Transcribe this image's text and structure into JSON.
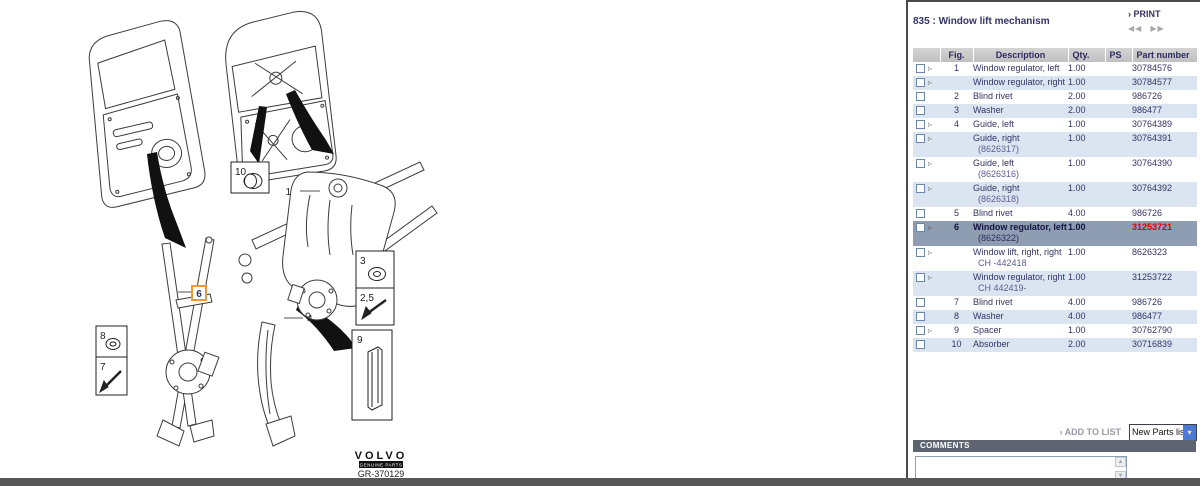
{
  "header": {
    "title": "835 : Window lift mechanism",
    "print": {
      "chevron": "›",
      "label": "PRINT"
    },
    "pager": {
      "prev": "◀◀",
      "next": "▶▶"
    }
  },
  "table": {
    "columns": {
      "checkbox": "",
      "fig": "Fig.",
      "description": "Description",
      "qty": "Qty.",
      "ps": "PS",
      "part": "Part number"
    },
    "rows": [
      {
        "fig": "1",
        "desc": "Window regulator, left",
        "sub": "",
        "qty": "1.00",
        "ps": "",
        "part": "30784576",
        "arrow": true,
        "selected": false,
        "part_red": false
      },
      {
        "fig": "",
        "desc": "Window regulator, right",
        "sub": "",
        "qty": "1.00",
        "ps": "",
        "part": "30784577",
        "arrow": true,
        "selected": false,
        "part_red": false
      },
      {
        "fig": "2",
        "desc": "Blind rivet",
        "sub": "",
        "qty": "2.00",
        "ps": "",
        "part": "986726",
        "arrow": false,
        "selected": false,
        "part_red": false
      },
      {
        "fig": "3",
        "desc": "Washer",
        "sub": "",
        "qty": "2.00",
        "ps": "",
        "part": "986477",
        "arrow": false,
        "selected": false,
        "part_red": false
      },
      {
        "fig": "4",
        "desc": "Guide, left",
        "sub": "",
        "qty": "1.00",
        "ps": "",
        "part": "30764389",
        "arrow": true,
        "selected": false,
        "part_red": false
      },
      {
        "fig": "",
        "desc": "Guide, right",
        "sub": "(8626317)",
        "qty": "1.00",
        "ps": "",
        "part": "30764391",
        "arrow": true,
        "selected": false,
        "part_red": false
      },
      {
        "fig": "",
        "desc": "Guide, left",
        "sub": "(8626316)",
        "qty": "1.00",
        "ps": "",
        "part": "30764390",
        "arrow": true,
        "selected": false,
        "part_red": false
      },
      {
        "fig": "",
        "desc": "Guide, right",
        "sub": "(8626318)",
        "qty": "1.00",
        "ps": "",
        "part": "30764392",
        "arrow": true,
        "selected": false,
        "part_red": false
      },
      {
        "fig": "5",
        "desc": "Blind rivet",
        "sub": "",
        "qty": "4.00",
        "ps": "",
        "part": "986726",
        "arrow": false,
        "selected": false,
        "part_red": false
      },
      {
        "fig": "6",
        "desc": "Window regulator, left",
        "sub": "(8626322)",
        "qty": "1.00",
        "ps": "",
        "part": "31253721",
        "arrow": true,
        "selected": true,
        "part_red": true
      },
      {
        "fig": "",
        "desc": "Window lift, right, right",
        "sub": "CH -442418",
        "qty": "1.00",
        "ps": "",
        "part": "8626323",
        "arrow": true,
        "selected": false,
        "part_red": false
      },
      {
        "fig": "",
        "desc": "Window regulator, right",
        "sub": "CH 442419-",
        "qty": "1.00",
        "ps": "",
        "part": "31253722",
        "arrow": true,
        "selected": false,
        "part_red": false
      },
      {
        "fig": "7",
        "desc": "Blind rivet",
        "sub": "",
        "qty": "4.00",
        "ps": "",
        "part": "986726",
        "arrow": false,
        "selected": false,
        "part_red": false
      },
      {
        "fig": "8",
        "desc": "Washer",
        "sub": "",
        "qty": "4.00",
        "ps": "",
        "part": "986477",
        "arrow": false,
        "selected": false,
        "part_red": false
      },
      {
        "fig": "9",
        "desc": "Spacer",
        "sub": "",
        "qty": "1.00",
        "ps": "",
        "part": "30762790",
        "arrow": true,
        "selected": false,
        "part_red": false
      },
      {
        "fig": "10",
        "desc": "Absorber",
        "sub": "",
        "qty": "2.00",
        "ps": "",
        "part": "30716839",
        "arrow": false,
        "selected": false,
        "part_red": false
      }
    ]
  },
  "actions": {
    "add_chevron": "›",
    "add_to_list": "ADD TO LIST",
    "parts_list_selected": "New Parts list",
    "select_arrow": "▾"
  },
  "comments": {
    "label": "COMMENTS",
    "value": ""
  },
  "diagram": {
    "callouts": {
      "c1": "1",
      "c25": "2,5",
      "c3": "3",
      "c4": "4",
      "c6": "6",
      "c7": "7",
      "c8": "8",
      "c9": "9",
      "c10": "10"
    },
    "logo": "VOLVO",
    "logo_sub": "GENUINE PARTS",
    "drawing_number": "GR-370129"
  },
  "colors": {
    "accent_navy": "#333366",
    "selected_row_bg": "#8e9db2",
    "alt_row_bg": "#dbe5f1",
    "part_highlight_red": "#e00000",
    "callout_highlight_orange": "#ee9933",
    "comments_bar": "#5f6570"
  }
}
